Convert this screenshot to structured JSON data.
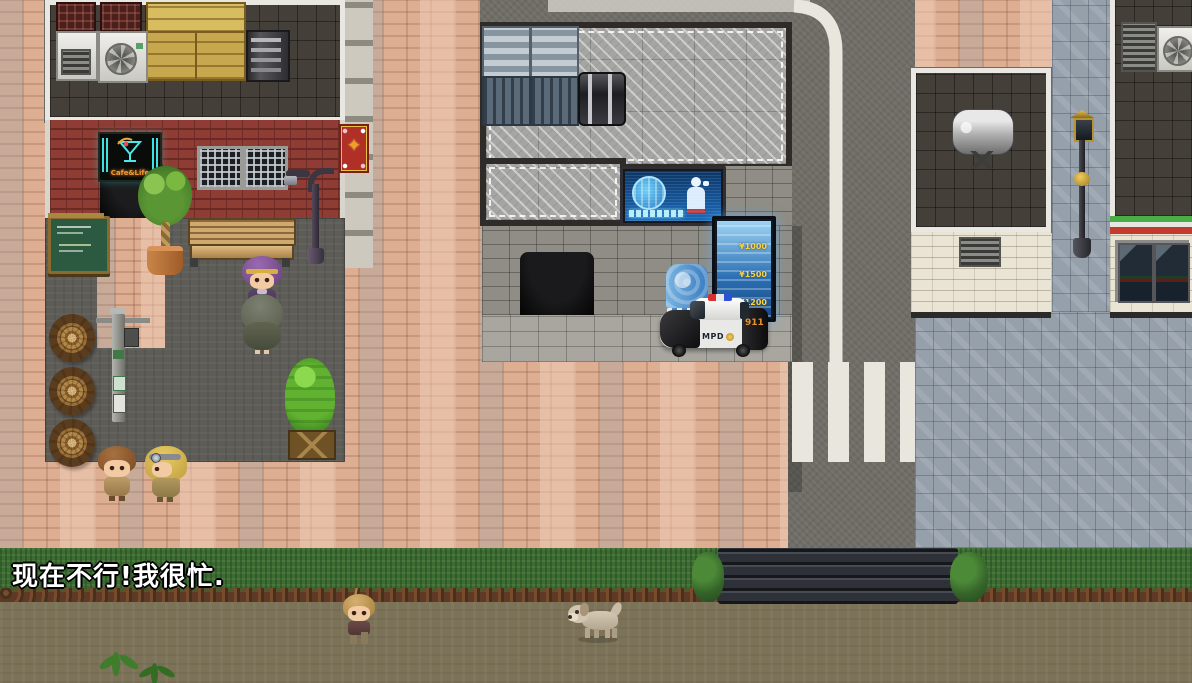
{
  "game": {
    "dialog_text": "现在不行!我很忙.",
    "neon_sign_text": "Cafe&Life",
    "vending_kiosk": {
      "price_1": "¥1000",
      "price_2": "¥1500",
      "price_3": "¥1200"
    },
    "police_car": {
      "door_label": "MPD",
      "rear_label": "911"
    },
    "colors": {
      "kiosk_glow": "#5ab4ff",
      "price_text": "#ffd23a",
      "police_rear_text": "#e8902c"
    }
  }
}
